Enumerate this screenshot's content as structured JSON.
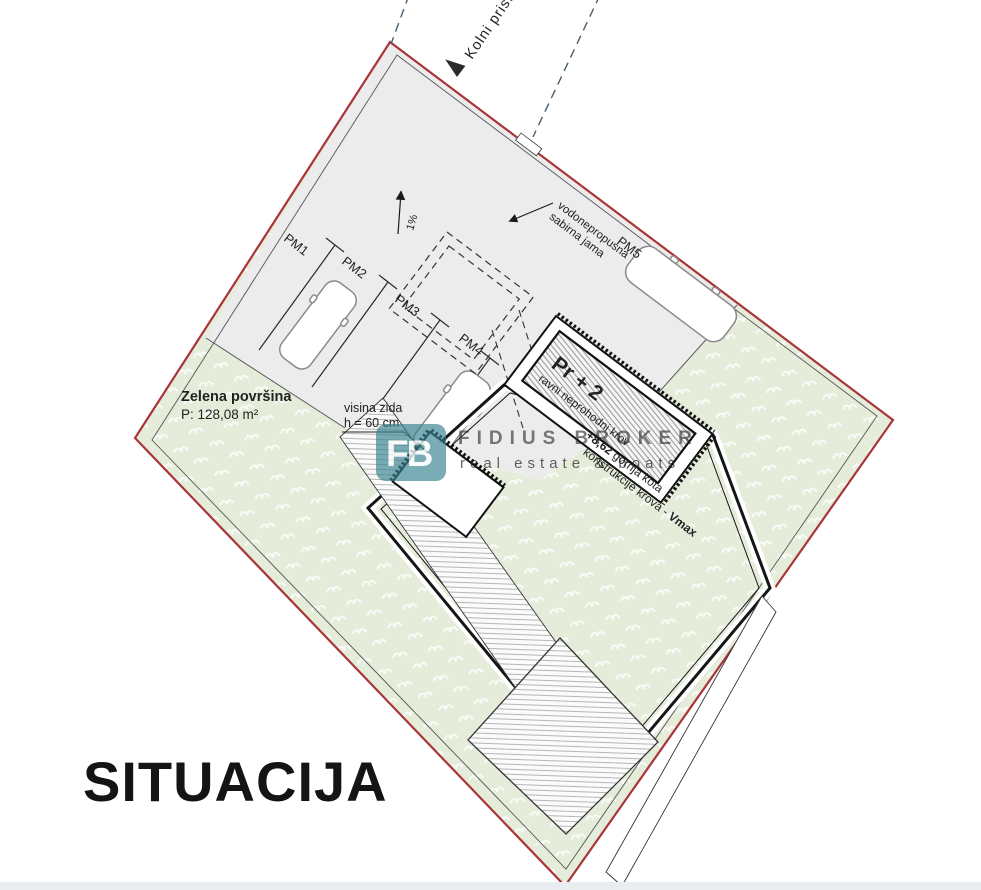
{
  "page": {
    "width": 981,
    "height": 890,
    "title": "SITUACIJA",
    "footer_bar_color": "#e9edf0"
  },
  "watermark": {
    "logo_monogram": "FB",
    "brand_name": "FIDIUS BROKER",
    "tagline": "real estate & boats",
    "brand_color": "#35818f",
    "tagline_color": "#8fbfc7"
  },
  "plan": {
    "access_road_label": "Kolni pristup",
    "slope_label": "1%",
    "parking_spaces": [
      "PM1",
      "PM2",
      "PM3",
      "PM4",
      "PM5"
    ],
    "pit_label": {
      "line1": "vodonepropusna",
      "line2": "sabirna jama"
    },
    "building": {
      "floors": "Pr + 2",
      "roof": "ravni neprohodni krov",
      "height_value": "+8,62",
      "height_text1": " gornja kota",
      "height_text2": "konstrukcije krova - ",
      "height_max": "Vmax"
    },
    "green_area": {
      "name": "Zelena površina",
      "area": "P: 128,08 m²"
    },
    "wall": {
      "line1": "visina zida",
      "line2": "h = 60 cm"
    },
    "colors": {
      "boundary": "#a93439",
      "paved": "#ececec",
      "green": "#e5edda",
      "road_dash": "#4a5f6d"
    }
  }
}
